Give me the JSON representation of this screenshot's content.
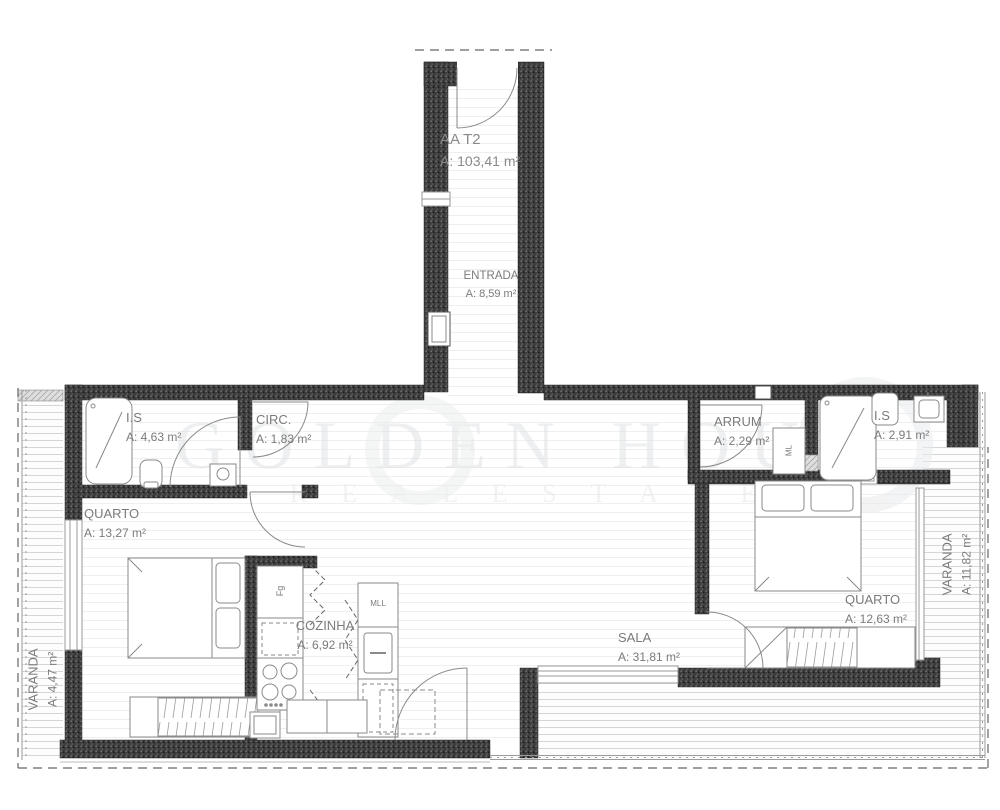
{
  "plan": {
    "title": "AA T2",
    "title_area": "A: 103,41 m²",
    "watermark_line1": "GOLDEN HOUR",
    "watermark_line2": "R E A L   E S T A T E",
    "rooms": {
      "entrada": {
        "name": "ENTRADA",
        "area": "A: 8,59 m²"
      },
      "is_left": {
        "name": "I.S",
        "area": "A: 4,63 m²"
      },
      "circ": {
        "name": "CIRC.",
        "area": "A: 1,83 m²"
      },
      "arrum": {
        "name": "ARRUM",
        "area": "A: 2,29 m²"
      },
      "is_right": {
        "name": "I.S",
        "area": "A: 2,91 m²"
      },
      "quarto_left": {
        "name": "QUARTO",
        "area": "A: 13,27 m²"
      },
      "quarto_right": {
        "name": "QUARTO",
        "area": "A: 12,63 m²"
      },
      "cozinha": {
        "name": "COZINHA",
        "area": "A: 6,92 m²"
      },
      "sala": {
        "name": "SALA",
        "area": "A: 31,81 m²"
      },
      "varanda_left": {
        "name": "VARANDA",
        "area": "A: 4,47 m²"
      },
      "varanda_right": {
        "name": "VARANDA",
        "area": "A: 11,82 m²"
      }
    },
    "appliances": {
      "fridge": "Fg",
      "dishwasher": "MLL",
      "washer": "ML"
    },
    "colors": {
      "wall": "#3c3c3c",
      "label": "#7b7b7b",
      "deck_line": "#d6d6d6",
      "floor_line": "#efefef",
      "watermark": "#e4e6e8",
      "fixture": "#8a8a8a"
    }
  }
}
